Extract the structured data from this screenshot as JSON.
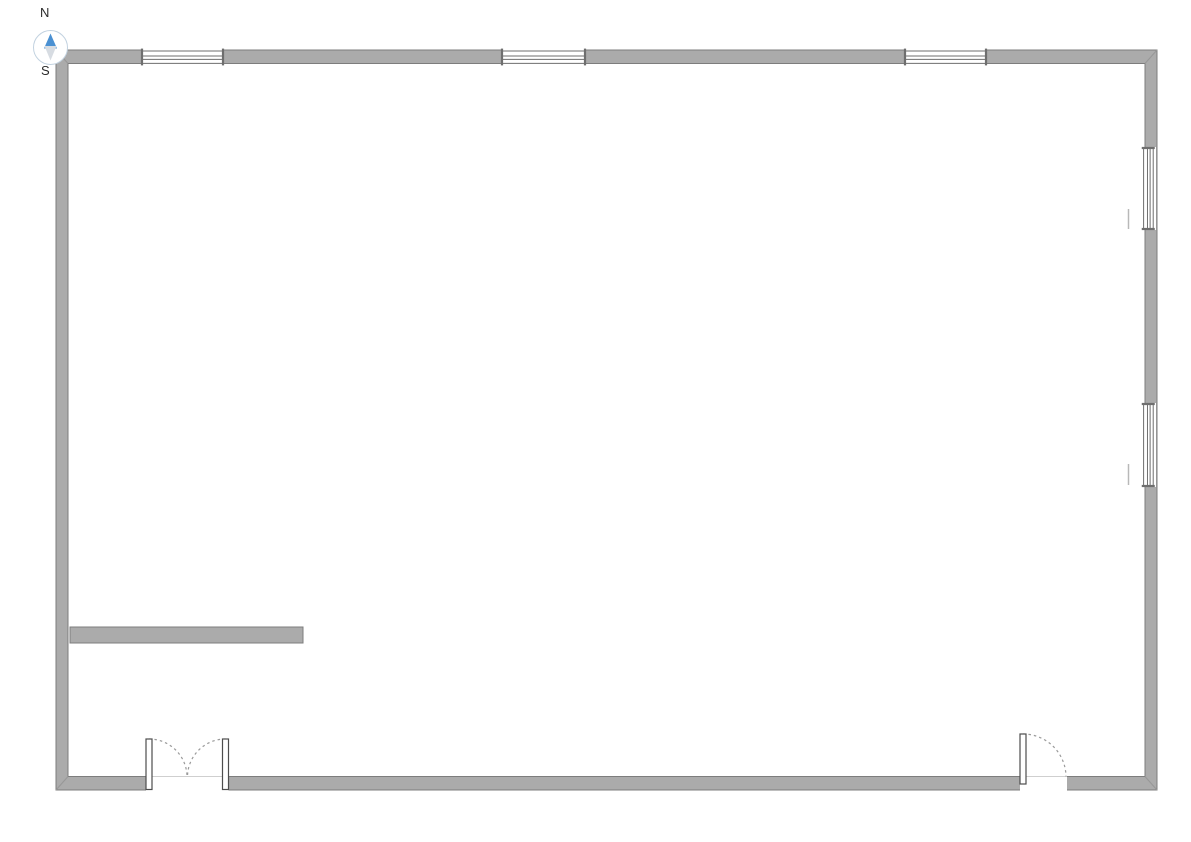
{
  "canvas": {
    "width": 1191,
    "height": 842,
    "background": "#ffffff"
  },
  "compass": {
    "north_label": "N",
    "south_label": "S",
    "north_needle_color": "#4a90d2",
    "south_needle_color": "#d7dce2",
    "ring_color": "#c2d2e0",
    "dial_fill": "#ffffff"
  },
  "styles": {
    "wall_fill": "#ababab",
    "wall_stroke": "#7d7d7d",
    "miter_stroke": "#979797",
    "window_fill": "#ffffff",
    "window_line_stroke": "#6e6e6e",
    "door_leaf_fill": "#ffffff",
    "door_leaf_stroke": "#4d4d4d",
    "door_swing_stroke": "#9a9a9a",
    "opening_edge_stroke": "#cfcfcf",
    "sill_mark_stroke": "#b8b8b8"
  },
  "outer_wall": {
    "left": 56,
    "top": 50,
    "right": 1157,
    "bottom": 790,
    "side_thickness": 12,
    "tb_thickness": 13.5
  },
  "interior_walls": [
    {
      "name": "interior-wall-west",
      "x": 70,
      "y": 627,
      "w": 233,
      "h": 16
    }
  ],
  "windows": [
    {
      "name": "window-north-1",
      "orientation": "h",
      "x": 141,
      "y": 47,
      "w": 83,
      "h": 20
    },
    {
      "name": "window-north-2",
      "orientation": "h",
      "x": 501,
      "y": 47,
      "w": 85,
      "h": 20
    },
    {
      "name": "window-north-3",
      "orientation": "h",
      "x": 904,
      "y": 47,
      "w": 83,
      "h": 20
    },
    {
      "name": "window-east-1",
      "orientation": "v",
      "x": 1140.5,
      "y": 147,
      "w": 15.5,
      "h": 83
    },
    {
      "name": "window-east-2",
      "orientation": "v",
      "x": 1140.5,
      "y": 403,
      "w": 15.5,
      "h": 84
    }
  ],
  "sill_marks": [
    {
      "name": "window-east-1-sill-mark",
      "x": 1128.5,
      "y1": 209,
      "y2": 229
    },
    {
      "name": "window-east-2-sill-mark",
      "x": 1128.5,
      "y1": 464,
      "y2": 485
    }
  ],
  "doors": [
    {
      "name": "double-door-south",
      "opening": {
        "x": 146,
        "y": 775.8,
        "w": 82.5,
        "h": 15.5
      },
      "inner_edge_y": 776.5,
      "leaves": [
        {
          "x": 146,
          "y": 739,
          "w": 6,
          "h": 50.5
        },
        {
          "x": 222.5,
          "y": 739,
          "w": 6,
          "h": 50.5
        }
      ],
      "swings": [
        {
          "sx": 149,
          "sy": 739,
          "ex": 187,
          "ey": 776.5,
          "r": 38,
          "sweep": 1
        },
        {
          "sx": 225.5,
          "sy": 739,
          "ex": 187.5,
          "ey": 776.5,
          "r": 38,
          "sweep": 0
        }
      ]
    },
    {
      "name": "single-door-south",
      "opening": {
        "x": 1020,
        "y": 775.8,
        "w": 47,
        "h": 15.5
      },
      "inner_edge_y": 776.5,
      "leaves": [
        {
          "x": 1020,
          "y": 734,
          "w": 6,
          "h": 50
        }
      ],
      "swings": [
        {
          "sx": 1023,
          "sy": 734,
          "ex": 1066,
          "ey": 776.5,
          "r": 43,
          "sweep": 1
        }
      ]
    }
  ]
}
